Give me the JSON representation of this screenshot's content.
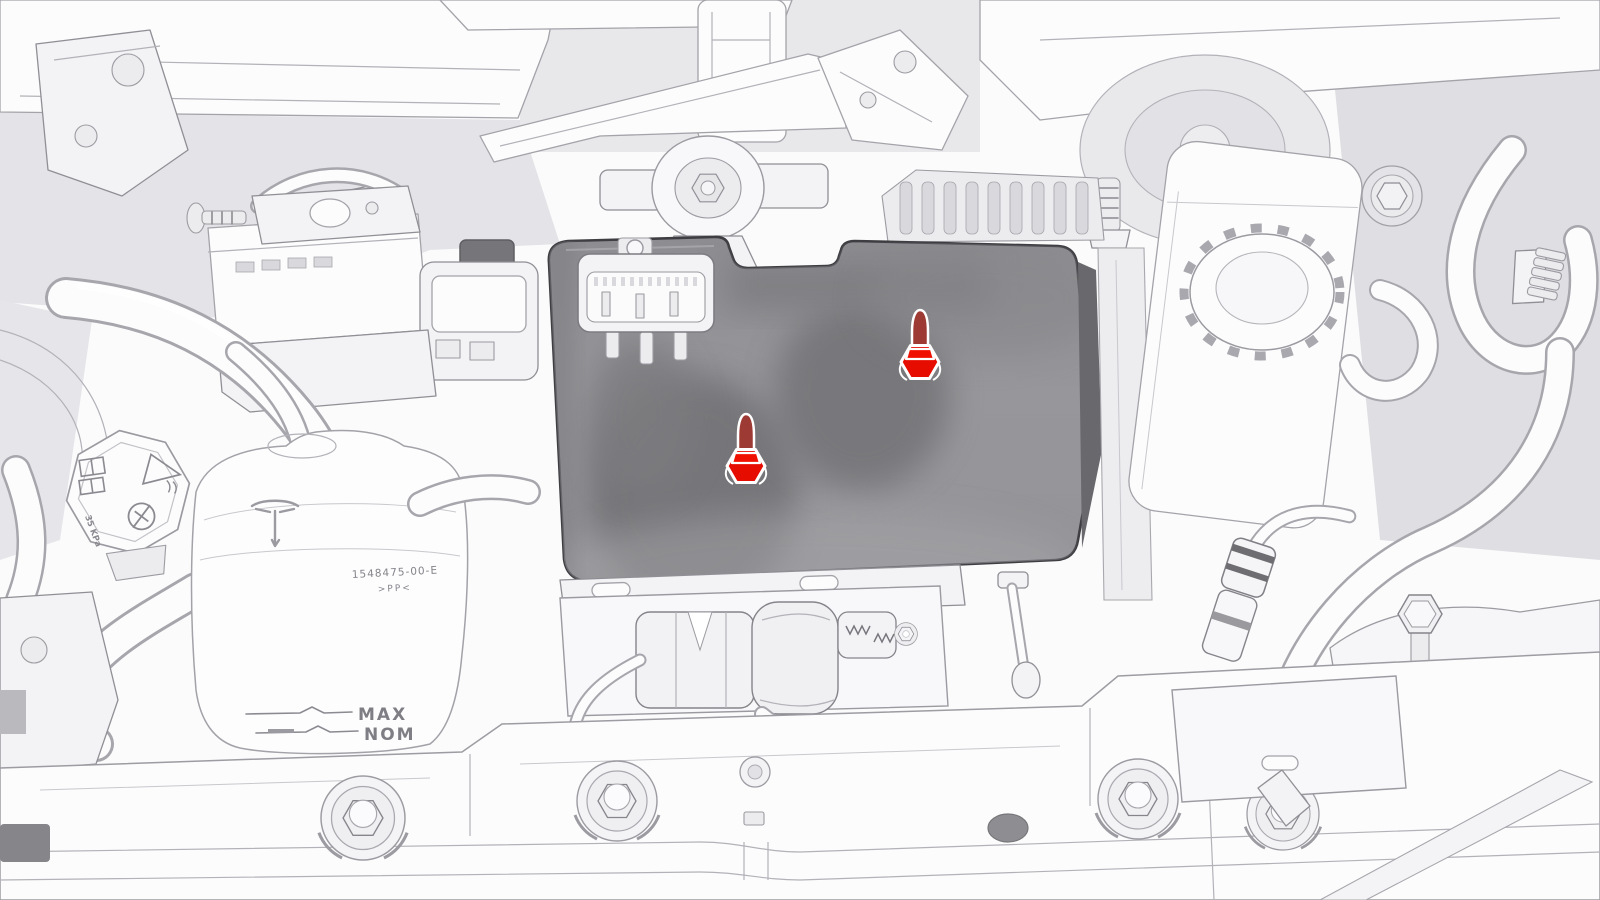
{
  "diagram": {
    "description": "front-compartment service illustration with penthouse cover and two highlighted fasteners",
    "canvas": {
      "width": 1600,
      "height": 900
    }
  },
  "colors": {
    "background": "#fbfbfc",
    "line_art": "#a3a3a9",
    "cover_panel": "#95959a",
    "cover_panel_edge": "#3e3e42",
    "highlight_red": "#e60c00",
    "highlight_shaft_red": "#9c3a33",
    "highlight_outline": "#ffffff"
  },
  "labels": {
    "reservoir_max": "MAX",
    "reservoir_nom": "NOM",
    "reservoir_part_number": "1548475-00-E",
    "reservoir_material_code": ">PP<",
    "cap_pressure_rating": "35 KPa"
  },
  "fasteners": [
    {
      "id": "cover-bolt-front",
      "x": 746,
      "y": 466,
      "transform": "translate(746,466)"
    },
    {
      "id": "cover-bolt-rear",
      "x": 920,
      "y": 362,
      "transform": "translate(920,362)"
    }
  ]
}
